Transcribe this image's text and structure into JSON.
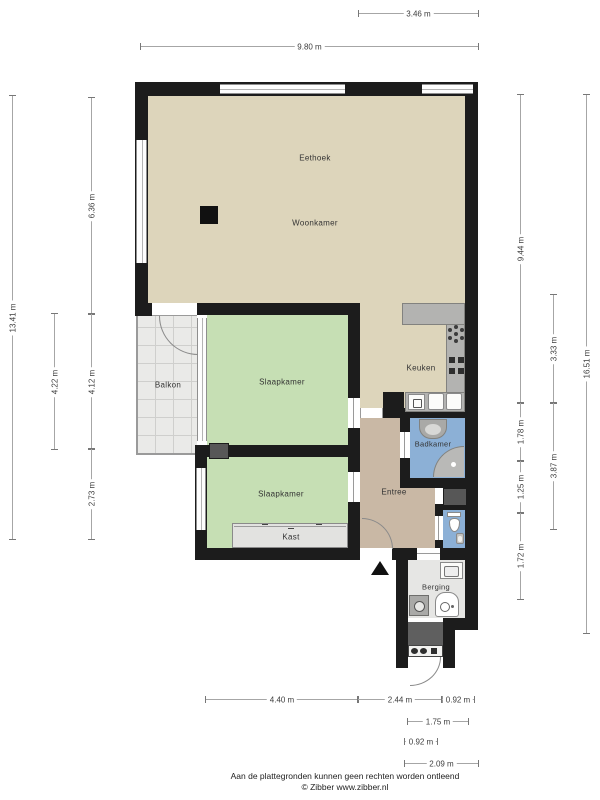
{
  "rooms": {
    "eethoek": "Eethoek",
    "woonkamer": "Woonkamer",
    "balkon": "Balkon",
    "slaapkamer_1": "Slaapkamer",
    "keuken": "Keuken",
    "badkamer": "Badkamer",
    "slaapkamer_2": "Slaapkamer",
    "entree": "Entree",
    "kast": "Kast",
    "berging": "Berging"
  },
  "dims": {
    "top": [
      "3.46 m",
      "9.80 m"
    ],
    "left": [
      "13.41 m",
      "4.22 m",
      "6.36 m",
      "4.12 m",
      "2.73 m"
    ],
    "right": [
      "9.44 m",
      "1.78 m",
      "1.25 m",
      "1.72 m",
      "3.33 m",
      "3.87 m",
      "16.51 m"
    ],
    "bottom": [
      "4.40 m",
      "2.44 m",
      "0.92 m",
      "1.75 m",
      "0.92 m",
      "2.09 m"
    ]
  },
  "footer": {
    "disclaimer": "Aan de plattegronden kunnen geen rechten worden ontleend",
    "credit": "© Zibber www.zibber.nl"
  },
  "colors": {
    "wall": "#1c1c1c",
    "living_floor": "#ddd5bb",
    "bedroom_floor": "#c6dfb4",
    "bathroom_floor": "#8cb0d6",
    "hall_floor": "#c9b8a5",
    "storage_floor": "#e6e6e4",
    "balcony_floor": "#eaeae8",
    "counter": "#b3b3b1",
    "shaft": "#575757"
  },
  "icons": {
    "stove": "burner-dot-cluster",
    "cooktop": "four-squares",
    "kitchen_sink": "double-basin",
    "dishwasher": "square-with-glyph",
    "washbasin": "rounded-basin",
    "shower": "quarter-circle-corner",
    "toilet": "bowl-with-tank",
    "fountain_sink": "small-basin",
    "washing_machine": "drum-square",
    "boiler": "cylinder",
    "meters": "meter-row",
    "column": "black-square",
    "entrance_marker": "triangle-up"
  }
}
